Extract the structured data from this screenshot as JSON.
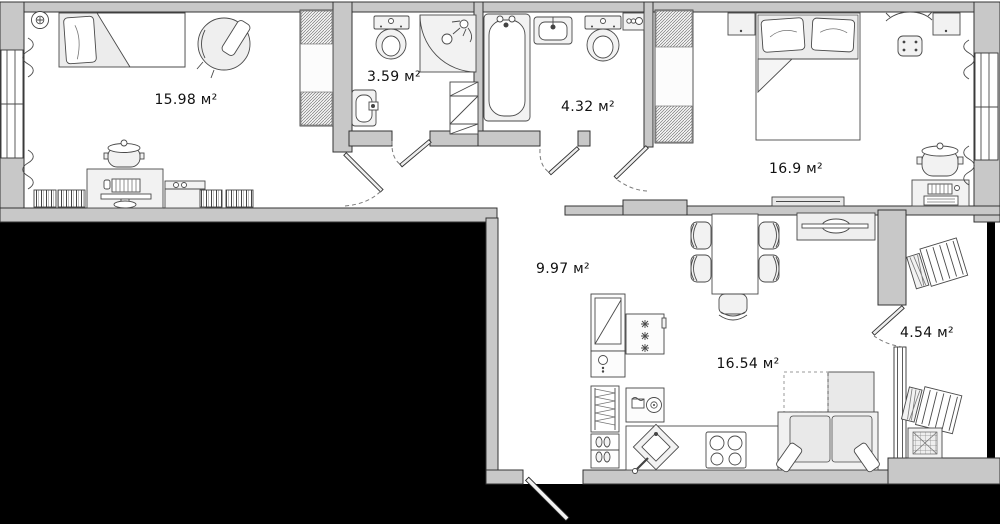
{
  "plan": {
    "type": "apartment-floor-plan",
    "area_unit": "м²",
    "rooms": [
      {
        "id": "bedroom-1",
        "area": "15.98",
        "label": "15.98 м²"
      },
      {
        "id": "bathroom-small",
        "area": "3.59",
        "label": "3.59 м²"
      },
      {
        "id": "bathroom-large",
        "area": "4.32",
        "label": "4.32 м²"
      },
      {
        "id": "bedroom-2",
        "area": "16.9",
        "label": "16.9 м²"
      },
      {
        "id": "hallway",
        "area": "9.97",
        "label": "9.97 м²"
      },
      {
        "id": "kitchen-living",
        "area": "16.54",
        "label": "16.54 м²"
      },
      {
        "id": "balcony",
        "area": "4.54",
        "label": "4.54 м²"
      }
    ],
    "colors": {
      "wall": "#c8c8c8",
      "outline": "#333333",
      "furniture": "#f2f2f2",
      "floor": "#ffffff",
      "void": "#000000"
    }
  }
}
